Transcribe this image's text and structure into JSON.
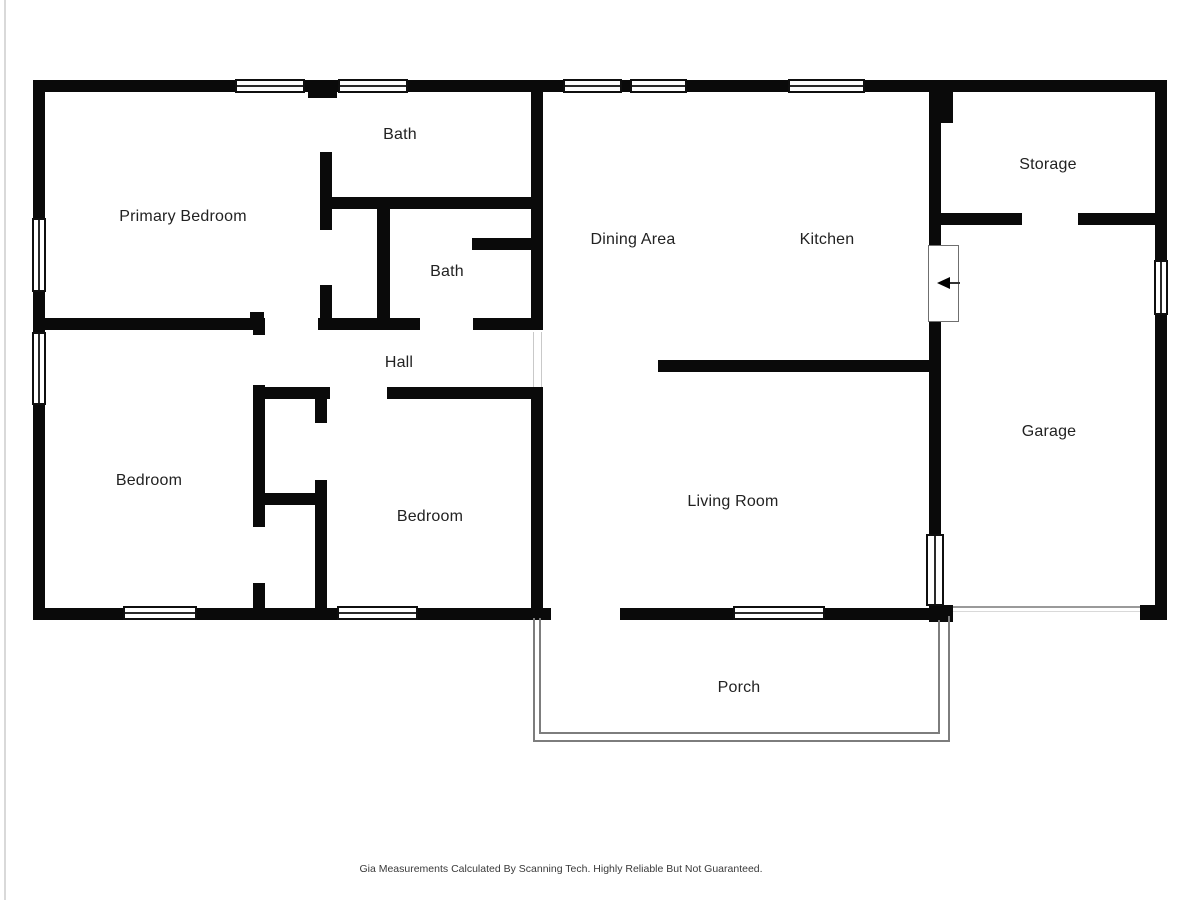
{
  "page": {
    "background": "#ffffff",
    "wall_color": "#0a0a0a",
    "label_color": "#222222",
    "porch_line_color": "#7d7d7d"
  },
  "footer": {
    "text": "Gia Measurements Calculated By Scanning Tech. Highly Reliable But Not Guaranteed.",
    "x": 561,
    "y": 863
  },
  "floorplan": {
    "rooms": [
      {
        "name": "primary-bedroom",
        "label": "Primary Bedroom",
        "x": 183,
        "y": 217
      },
      {
        "name": "bath-top",
        "label": "Bath",
        "x": 400,
        "y": 135
      },
      {
        "name": "bath-lower",
        "label": "Bath",
        "x": 447,
        "y": 272
      },
      {
        "name": "hall",
        "label": "Hall",
        "x": 399,
        "y": 363
      },
      {
        "name": "dining-area",
        "label": "Dining Area",
        "x": 633,
        "y": 240
      },
      {
        "name": "kitchen",
        "label": "Kitchen",
        "x": 827,
        "y": 240
      },
      {
        "name": "storage",
        "label": "Storage",
        "x": 1048,
        "y": 165
      },
      {
        "name": "bedroom-left",
        "label": "Bedroom",
        "x": 149,
        "y": 481
      },
      {
        "name": "bedroom-center",
        "label": "Bedroom",
        "x": 430,
        "y": 517
      },
      {
        "name": "living-room",
        "label": "Living Room",
        "x": 733,
        "y": 502
      },
      {
        "name": "garage",
        "label": "Garage",
        "x": 1049,
        "y": 432
      },
      {
        "name": "porch",
        "label": "Porch",
        "x": 739,
        "y": 688
      }
    ],
    "walls": [
      [
        33,
        80,
        1134,
        12
      ],
      [
        33,
        80,
        12,
        538
      ],
      [
        1155,
        80,
        12,
        540
      ],
      [
        33,
        608,
        90,
        12
      ],
      [
        197,
        608,
        140,
        12
      ],
      [
        418,
        608,
        133,
        12
      ],
      [
        620,
        608,
        113,
        12
      ],
      [
        825,
        608,
        104,
        12
      ],
      [
        929,
        605,
        24,
        17
      ],
      [
        1140,
        605,
        27,
        15
      ],
      [
        308,
        92,
        29,
        6
      ],
      [
        320,
        152,
        12,
        78
      ],
      [
        320,
        285,
        12,
        33
      ],
      [
        328,
        197,
        207,
        12
      ],
      [
        377,
        209,
        13,
        109
      ],
      [
        472,
        238,
        59,
        12
      ],
      [
        531,
        87,
        12,
        243
      ],
      [
        531,
        387,
        12,
        221
      ],
      [
        33,
        318,
        229,
        12
      ],
      [
        250,
        312,
        14,
        18
      ],
      [
        318,
        318,
        102,
        12
      ],
      [
        473,
        318,
        70,
        12
      ],
      [
        253,
        387,
        77,
        12
      ],
      [
        387,
        387,
        156,
        12
      ],
      [
        253,
        318,
        12,
        17
      ],
      [
        253,
        385,
        12,
        142
      ],
      [
        253,
        583,
        12,
        35
      ],
      [
        315,
        387,
        12,
        36
      ],
      [
        315,
        480,
        12,
        138
      ],
      [
        253,
        493,
        74,
        12
      ],
      [
        658,
        360,
        271,
        12
      ],
      [
        929,
        92,
        12,
        153
      ],
      [
        929,
        92,
        24,
        31
      ],
      [
        929,
        322,
        12,
        212
      ],
      [
        929,
        213,
        93,
        12
      ],
      [
        1078,
        213,
        79,
        12
      ]
    ],
    "windows": [
      {
        "x": 235,
        "y": 79,
        "w": 70,
        "h": 14,
        "orient": "h"
      },
      {
        "x": 338,
        "y": 79,
        "w": 70,
        "h": 14,
        "orient": "h"
      },
      {
        "x": 563,
        "y": 79,
        "w": 59,
        "h": 14,
        "orient": "h"
      },
      {
        "x": 630,
        "y": 79,
        "w": 57,
        "h": 14,
        "orient": "h"
      },
      {
        "x": 788,
        "y": 79,
        "w": 77,
        "h": 14,
        "orient": "h"
      },
      {
        "x": 123,
        "y": 606,
        "w": 74,
        "h": 14,
        "orient": "h"
      },
      {
        "x": 337,
        "y": 606,
        "w": 81,
        "h": 14,
        "orient": "h"
      },
      {
        "x": 733,
        "y": 606,
        "w": 92,
        "h": 14,
        "orient": "h"
      },
      {
        "x": 32,
        "y": 218,
        "w": 14,
        "h": 74,
        "orient": "v"
      },
      {
        "x": 32,
        "y": 332,
        "w": 14,
        "h": 73,
        "orient": "v"
      },
      {
        "x": 1154,
        "y": 260,
        "w": 14,
        "h": 55,
        "orient": "v"
      },
      {
        "x": 926,
        "y": 534,
        "w": 18,
        "h": 72,
        "orient": "v"
      }
    ],
    "porch_lines": [
      [
        539,
        618,
        2,
        116
      ],
      [
        539,
        732,
        401,
        2
      ],
      [
        938,
        620,
        2,
        114
      ],
      [
        533,
        618,
        2,
        124
      ],
      [
        533,
        740,
        417,
        2
      ],
      [
        948,
        616,
        2,
        126
      ]
    ],
    "garage_door_lines": [
      {
        "rect": [
          953,
          606,
          187,
          2
        ],
        "cls": "thin-line"
      },
      {
        "rect": [
          953,
          611,
          187,
          1
        ],
        "cls": "faint-line"
      }
    ],
    "opening_lines": [
      [
        533,
        332,
        1,
        55
      ],
      [
        541,
        332,
        1,
        55
      ]
    ],
    "page_edge_line": [
      4,
      0,
      2,
      900
    ],
    "door": {
      "leaf": [
        928,
        245,
        31,
        77
      ],
      "arrow_x": 937,
      "arrow_y": 277,
      "arrow_line": [
        950,
        282,
        10,
        2
      ]
    }
  }
}
